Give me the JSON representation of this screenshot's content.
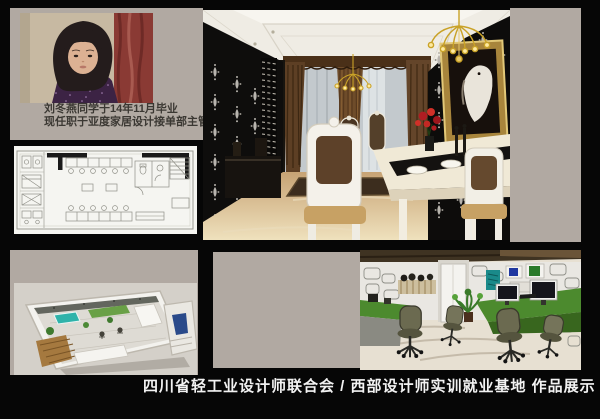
{
  "colors": {
    "stage": "#060606",
    "panel": "#b1a9a2",
    "ink": "#3b3833",
    "caption": "#f2f2f2",
    "gold": "#c9a227",
    "desk-green": "#4c8a2e",
    "marble": "#d9bd92",
    "damask-black": "#0d0c0b",
    "curtain-brown": "#5d3f24",
    "pool-teal": "#2fb3aa"
  },
  "profile": {
    "line1": "刘冬燕同学于14年11月毕业",
    "line2": "现任职于亚度家居设计接单部主管"
  },
  "footer": {
    "caption": "四川省轻工业设计师联合会 / 西部设计师实训就业基地  作品展示"
  },
  "panels": {
    "portrait": "portrait-photo",
    "floor_plan": "floor-plan-cad-drawing",
    "dining": "dining-room-render",
    "isometric": "isometric-interior-render",
    "office": "office-interior-render"
  }
}
